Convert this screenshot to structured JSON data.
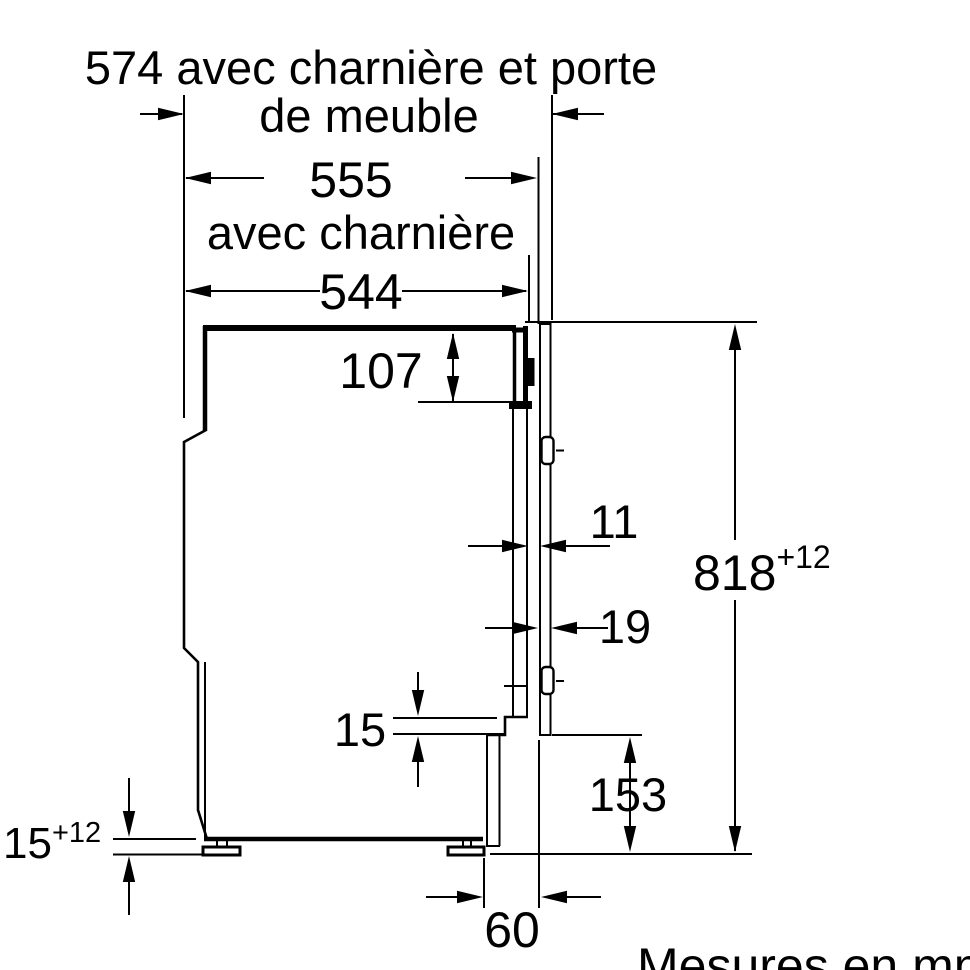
{
  "diagram": {
    "title_line1": "574 avec charnière et porte",
    "title_line2": "de meuble",
    "width_with_hinge": "555",
    "width_with_hinge_label": "avec charnière",
    "appliance_width": "544",
    "top_offset": "107",
    "gap_front": "11",
    "door_thickness": "19",
    "niche_height": "818",
    "niche_height_tolerance": "+12",
    "plinth_gap": "15",
    "door_bottom_clearance": "153",
    "feet_height": "15",
    "feet_height_tolerance": "+12",
    "plinth_recess": "60",
    "unit_note": "Mesures en mm",
    "colors": {
      "line": "#000000",
      "background": "#ffffff"
    }
  }
}
